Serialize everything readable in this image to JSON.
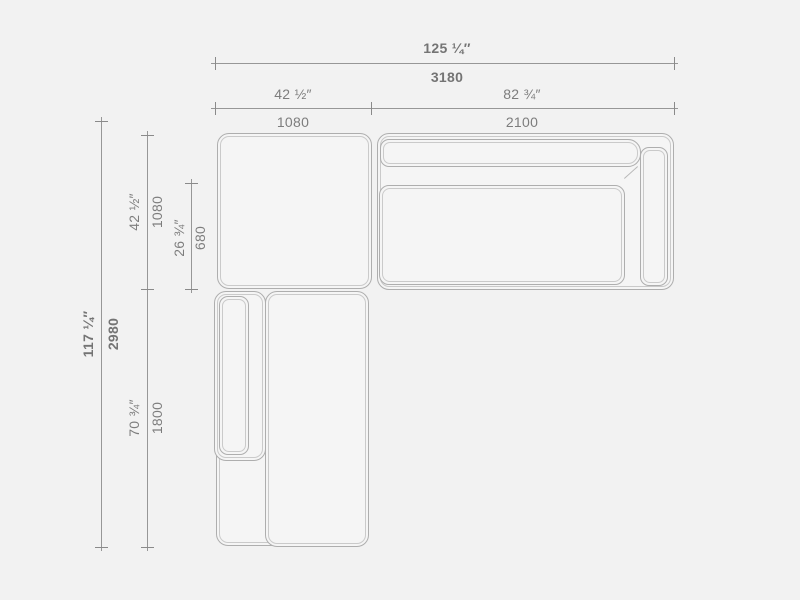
{
  "drawing": {
    "title": "sectional-sofa-top-view-technical-drawing",
    "units": [
      "inches",
      "mm"
    ],
    "colors": {
      "background": "#f2f2f2",
      "piece_fill": "#f5f5f5",
      "outline": "#aeaeae",
      "seam": "#cacaca",
      "dimension_line": "#979797",
      "label_text": "#7d7d7d"
    },
    "dimensions": {
      "total_width": {
        "inches": "125 ¼″",
        "mm": "3180"
      },
      "left_section_width": {
        "inches": "42 ½″",
        "mm": "1080"
      },
      "right_section_width": {
        "inches": "82 ¾″",
        "mm": "2100"
      },
      "total_depth": {
        "inches": "117 ¼″",
        "mm": "2980"
      },
      "left_section_depth": {
        "inches": "42 ½″",
        "mm": "1080"
      },
      "seat_depth": {
        "inches": "26 ¾″",
        "mm": "680"
      },
      "chaise_length": {
        "inches": "70 ¾″",
        "mm": "1800"
      }
    }
  }
}
